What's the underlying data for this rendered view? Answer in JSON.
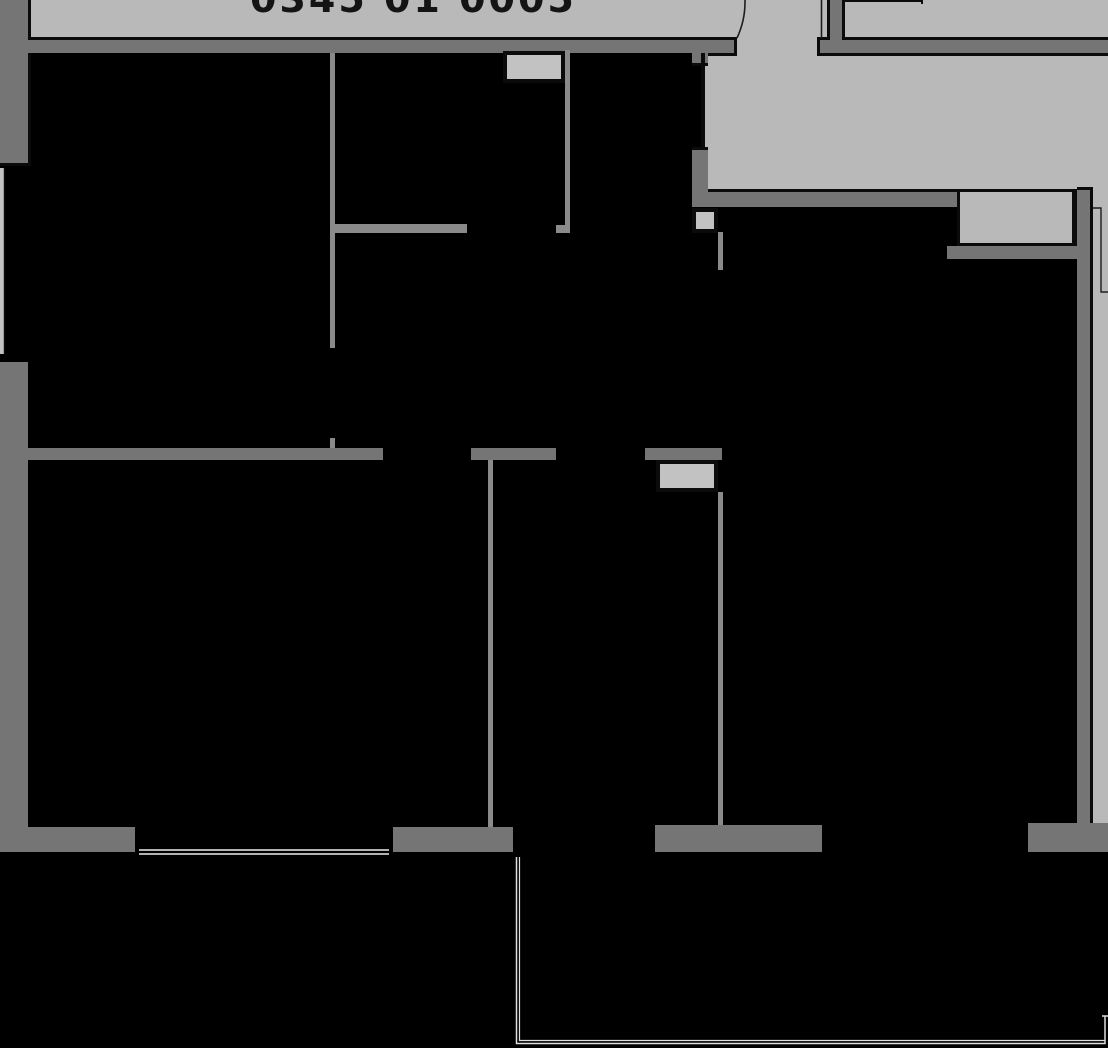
{
  "plan": {
    "label": "0345 01 0005",
    "type": "apartment-floor-plan"
  },
  "symbols": [
    "vent-shaft",
    "entry-door-swing",
    "side-door",
    "window",
    "terrace-outline"
  ],
  "colors": {
    "bg": "#000000",
    "common": "#b9b9b9",
    "wall": "#757575",
    "wallLight": "#8a8a8a",
    "outline": "#0b0b0b",
    "shaft": "#c2c2c2",
    "windowLine": "#ececec",
    "terraceLine": "#dedede",
    "label": "#141414"
  }
}
